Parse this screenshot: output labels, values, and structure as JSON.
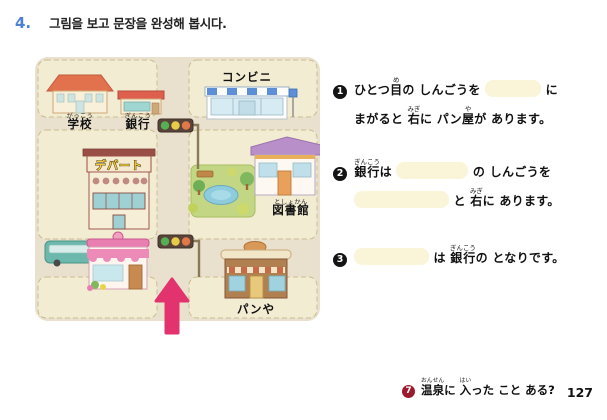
{
  "page": {
    "exercise_number": "4.",
    "instruction": "그림을 보고 문장을 완성해 봅시다.",
    "page_number": "127"
  },
  "colors": {
    "accent_blue": "#4b82d4",
    "footer_badge_red": "#9b1b2e",
    "arrow_pink": "#e2336e",
    "map_block_cream": "#f2ecd2",
    "map_road_gray": "#e9e1cd",
    "answer_blank_yellow": "#faf5d8"
  },
  "map": {
    "labels": {
      "school": {
        "text": "学校",
        "furigana": "がっこう"
      },
      "bank": {
        "text": "銀行",
        "furigana": "ぎんこう"
      },
      "convenience_store": {
        "text": "コンビニ",
        "furigana": ""
      },
      "department_store": {
        "text": "デパート",
        "furigana": ""
      },
      "library": {
        "text": "図書館",
        "furigana": "としょかん"
      },
      "bakery": {
        "text": "パンや",
        "furigana": ""
      }
    }
  },
  "exercises": [
    {
      "number": "1",
      "line1": [
        {
          "t": "ひとつ"
        },
        {
          "t": "目",
          "r": "め"
        },
        {
          "t": "の しんごうを "
        },
        {
          "blank": true,
          "w": 56
        },
        {
          "t": " に"
        }
      ],
      "line2": [
        {
          "t": "まがると "
        },
        {
          "t": "右",
          "r": "みぎ"
        },
        {
          "t": "に パン"
        },
        {
          "t": "屋",
          "r": "や"
        },
        {
          "t": "が あります。"
        }
      ]
    },
    {
      "number": "2",
      "line1": [
        {
          "t": "銀行",
          "r": "ぎんこう"
        },
        {
          "t": "は "
        },
        {
          "blank": true,
          "w": 72
        },
        {
          "t": " の しんごうを"
        }
      ],
      "line2": [
        {
          "blank": true,
          "w": 95
        },
        {
          "t": " と "
        },
        {
          "t": "右",
          "r": "みぎ"
        },
        {
          "t": "に あります。"
        }
      ]
    },
    {
      "number": "3",
      "line1": [
        {
          "blank": true,
          "w": 75
        },
        {
          "t": " は "
        },
        {
          "t": "銀行",
          "r": "ぎんこう"
        },
        {
          "t": "の となりです。"
        }
      ],
      "line2": []
    }
  ],
  "footer": {
    "number": "7",
    "segments": [
      {
        "t": "温泉",
        "r": "おんせん"
      },
      {
        "t": "に "
      },
      {
        "t": "入",
        "r": "はい"
      },
      {
        "t": "った こと ある?"
      }
    ],
    "page_number": "127"
  }
}
